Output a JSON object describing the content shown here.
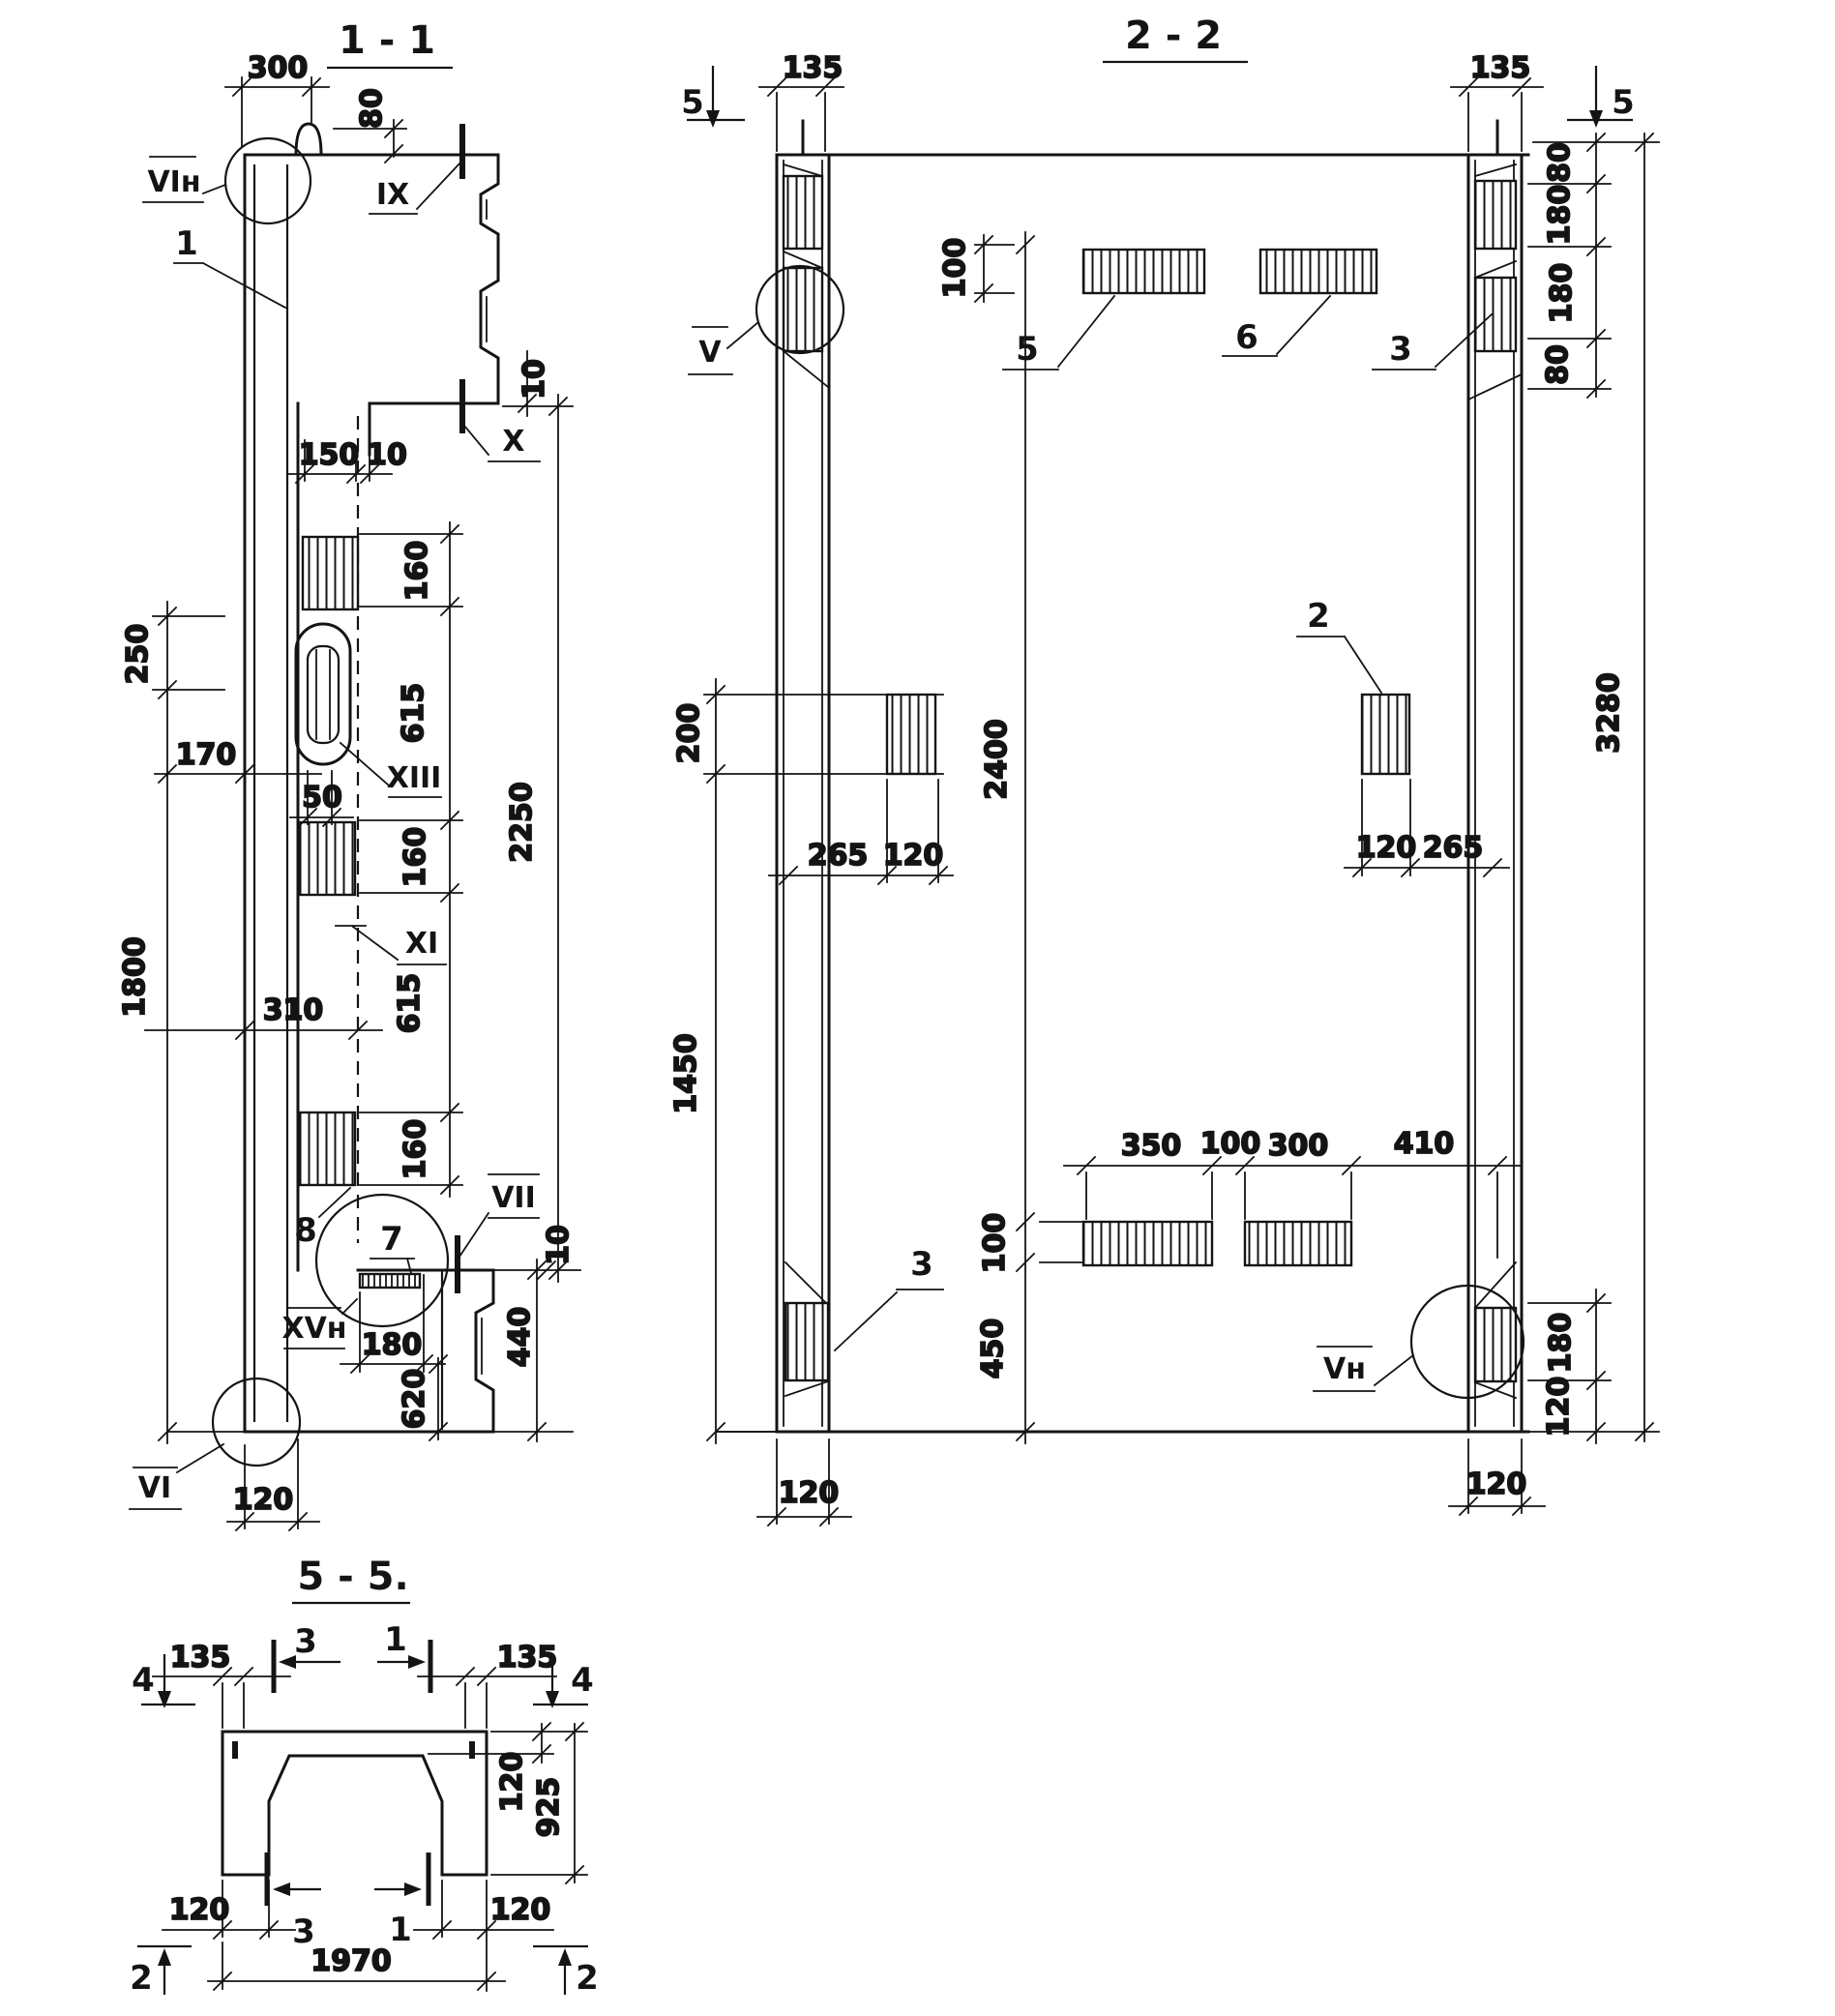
{
  "s11": {
    "title": "1 - 1",
    "d300": "300",
    "d80": "80",
    "d10": "10",
    "d150": "150",
    "d160": "160",
    "d615": "615",
    "d2250": "2250",
    "d250": "250",
    "d170": "170",
    "d50": "50",
    "d310": "310",
    "d1800": "1800",
    "d180": "180",
    "d620": "620",
    "d440": "440",
    "d120": "120",
    "det_vin": "VIн",
    "det_ix": "IX",
    "det_x": "X",
    "det_xiii": "XIII",
    "det_xi": "XI",
    "det_vii": "VII",
    "det_xvn": "XVн",
    "det_vi": "VI",
    "l1": "1",
    "l7": "7",
    "l8": "8"
  },
  "s22": {
    "title": "2 - 2",
    "m5": "5",
    "d135": "135",
    "d80": "80",
    "d180": "180",
    "d100": "100",
    "d3280": "3280",
    "d200": "200",
    "d2400": "2400",
    "d265": "265",
    "d120": "120",
    "d1450": "1450",
    "d350": "350",
    "d300": "300",
    "d410": "410",
    "d450": "450",
    "det_v": "V",
    "det_vn": "Vн",
    "l2": "2",
    "l3": "3",
    "l5": "5",
    "l6": "6"
  },
  "s55": {
    "title": "5 - 5.",
    "m4": "4",
    "m3": "3",
    "m1": "1",
    "m2": "2",
    "d135": "135",
    "d120": "120",
    "d925": "925",
    "d1970": "1970"
  }
}
